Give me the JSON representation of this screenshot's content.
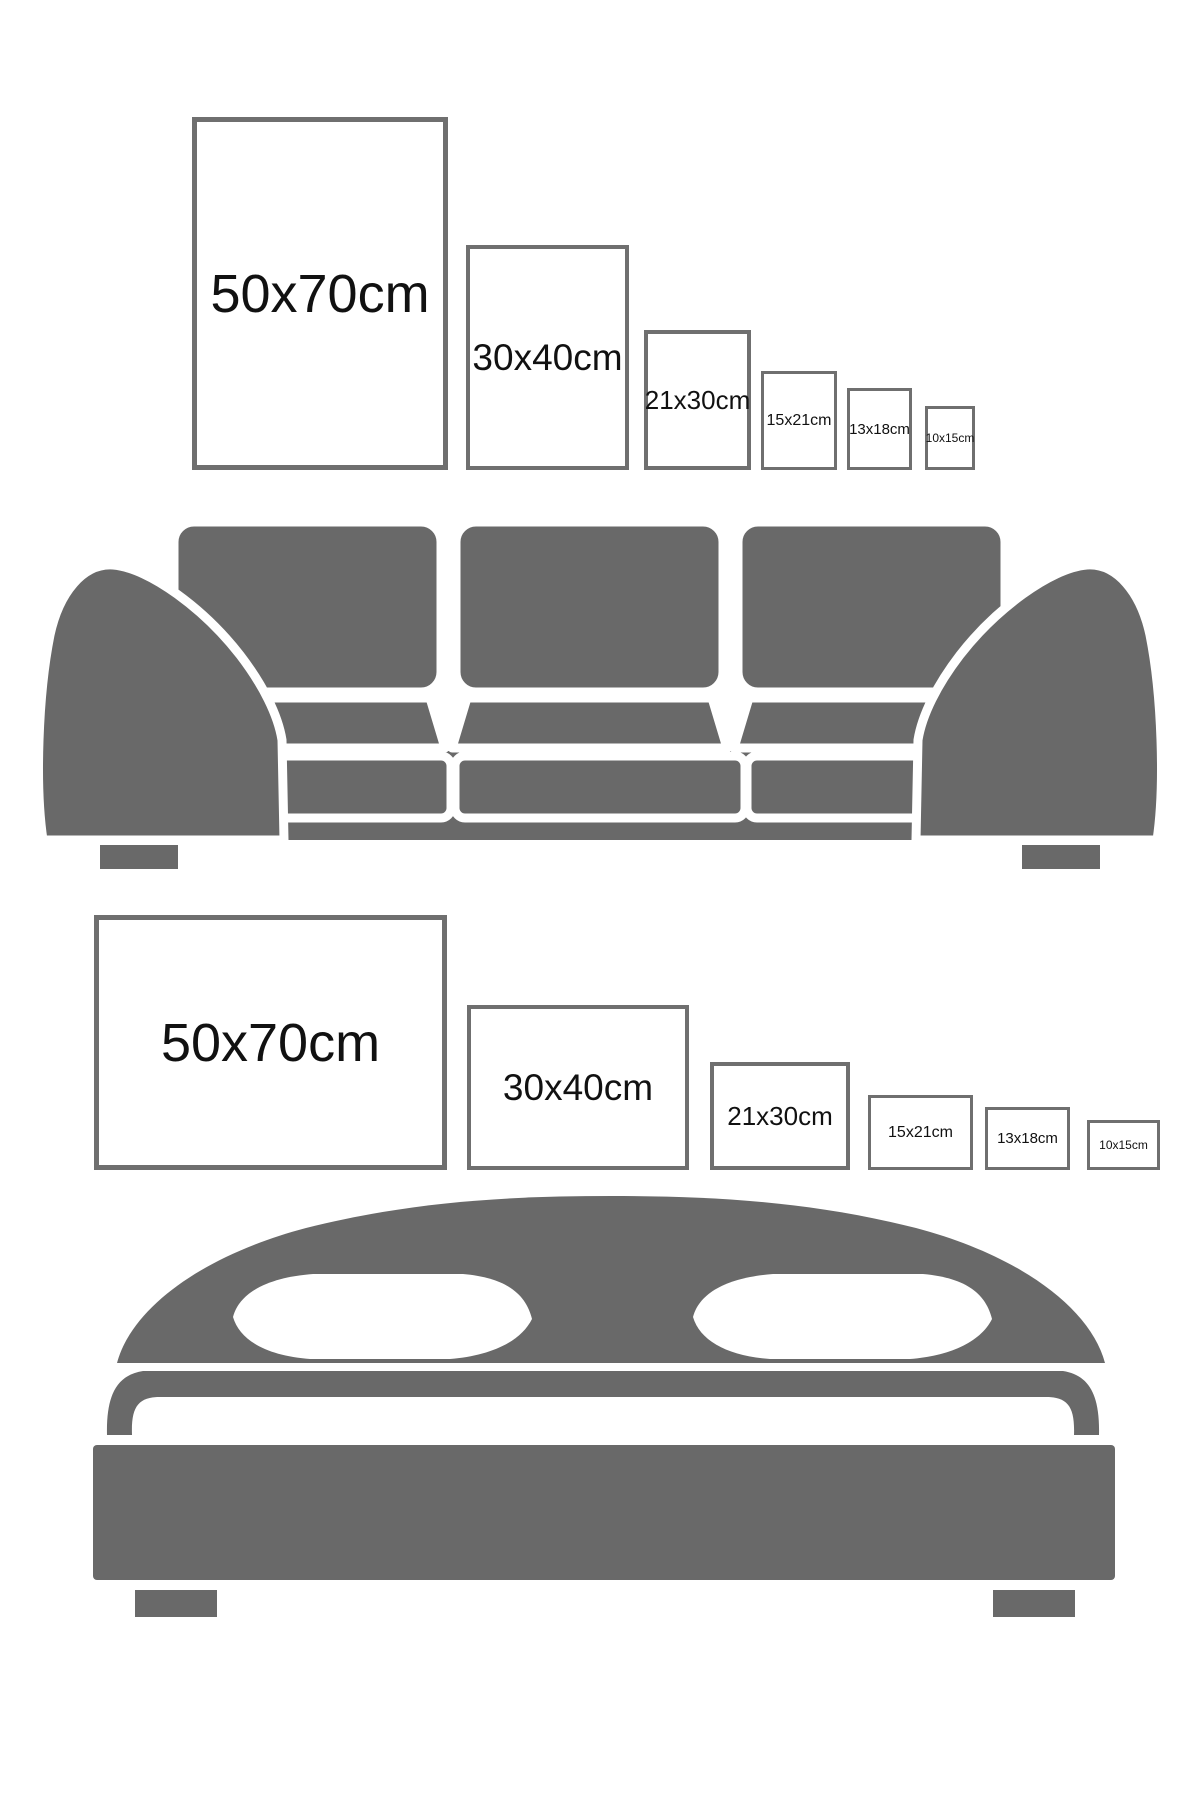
{
  "colors": {
    "furniture_gray": "#696969",
    "frame_border": "#6f6f6f",
    "label_color": "#111111",
    "background": "#ffffff",
    "separator": "#ffffff"
  },
  "sofa_section": {
    "furniture": "sofa",
    "frames": [
      {
        "label": "50x70cm",
        "orientation": "portrait"
      },
      {
        "label": "30x40cm",
        "orientation": "portrait"
      },
      {
        "label": "21x30cm",
        "orientation": "portrait"
      },
      {
        "label": "15x21cm",
        "orientation": "portrait"
      },
      {
        "label": "13x18cm",
        "orientation": "portrait"
      },
      {
        "label": "10x15cm",
        "orientation": "portrait"
      }
    ]
  },
  "bed_section": {
    "furniture": "bed",
    "frames": [
      {
        "label": "50x70cm",
        "orientation": "landscape"
      },
      {
        "label": "30x40cm",
        "orientation": "landscape"
      },
      {
        "label": "21x30cm",
        "orientation": "landscape"
      },
      {
        "label": "15x21cm",
        "orientation": "landscape"
      },
      {
        "label": "13x18cm",
        "orientation": "landscape"
      },
      {
        "label": "10x15cm",
        "orientation": "landscape"
      }
    ]
  }
}
